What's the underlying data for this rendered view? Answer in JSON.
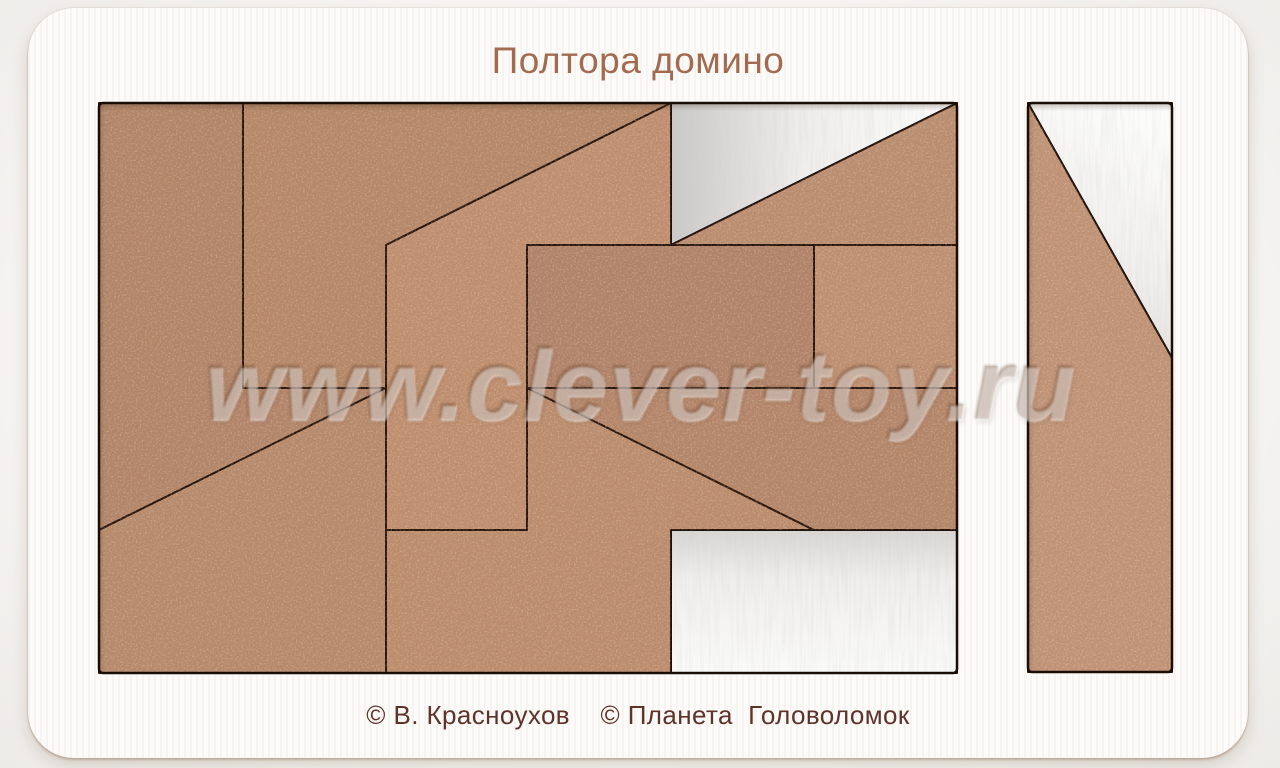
{
  "page": {
    "background": "#f2f1ef"
  },
  "card": {
    "title": "Полтора домино",
    "title_color": "#a26b50",
    "caption": "© В. Красноухов    © Планета  Головоломок",
    "caption_color": "#5e332a"
  },
  "watermark": {
    "text": "www.clever-toy.ru"
  },
  "puzzle": {
    "cut_color": "#23120a",
    "tray_outline_color": "#1a0d06",
    "backing_color": "#f2f1ee",
    "trays": [
      {
        "name": "main-tray-opening",
        "x": 99,
        "y": 103,
        "w": 858,
        "h": 570
      },
      {
        "name": "side-tray-opening",
        "x": 1028,
        "y": 103,
        "w": 144,
        "h": 569
      }
    ],
    "pieces": [
      {
        "id": "piece-left-pentagon",
        "color": "#b4866a",
        "points": [
          [
            99,
            103
          ],
          [
            243,
            103
          ],
          [
            243,
            388
          ],
          [
            386,
            388
          ],
          [
            99,
            530
          ]
        ]
      },
      {
        "id": "piece-bottom-left-quad",
        "color": "#b98b6d",
        "points": [
          [
            99,
            530
          ],
          [
            386,
            388
          ],
          [
            386,
            673
          ],
          [
            99,
            673
          ]
        ]
      },
      {
        "id": "piece-top-pentagon",
        "color": "#b78969",
        "points": [
          [
            243,
            103
          ],
          [
            671,
            103
          ],
          [
            386,
            245
          ],
          [
            386,
            388
          ],
          [
            243,
            388
          ]
        ]
      },
      {
        "id": "piece-middle-flag",
        "color": "#c19070",
        "points": [
          [
            386,
            245
          ],
          [
            671,
            103
          ],
          [
            671,
            245
          ],
          [
            527,
            245
          ],
          [
            527,
            530
          ],
          [
            386,
            530
          ]
        ]
      },
      {
        "id": "piece-bottom-step",
        "color": "#bd8e6e",
        "points": [
          [
            527,
            388
          ],
          [
            814,
            530
          ],
          [
            671,
            530
          ],
          [
            671,
            673
          ],
          [
            386,
            673
          ],
          [
            386,
            530
          ],
          [
            527,
            530
          ]
        ]
      },
      {
        "id": "piece-right-trapezoid",
        "color": "#b5876b",
        "points": [
          [
            527,
            388
          ],
          [
            957,
            388
          ],
          [
            957,
            530
          ],
          [
            814,
            530
          ]
        ]
      },
      {
        "id": "piece-top-right-triangle",
        "color": "#bd8f72",
        "points": [
          [
            671,
            245
          ],
          [
            957,
            103
          ],
          [
            957,
            245
          ]
        ]
      },
      {
        "id": "piece-right-square",
        "color": "#c09173",
        "points": [
          [
            814,
            245
          ],
          [
            957,
            245
          ],
          [
            957,
            388
          ],
          [
            814,
            388
          ]
        ]
      },
      {
        "id": "piece-domino-rect",
        "color": "#b2846a",
        "points": [
          [
            527,
            245
          ],
          [
            814,
            245
          ],
          [
            814,
            388
          ],
          [
            527,
            388
          ]
        ]
      },
      {
        "id": "piece-side-tray-clipped",
        "color": "#c29478",
        "points": [
          [
            1028,
            103
          ],
          [
            1172,
            358
          ],
          [
            1172,
            672
          ],
          [
            1028,
            672
          ]
        ]
      }
    ],
    "empty_slots": [
      {
        "id": "empty-slot-top-triangle",
        "shade": "right",
        "points": [
          [
            671,
            103
          ],
          [
            957,
            103
          ],
          [
            671,
            245
          ]
        ]
      },
      {
        "id": "empty-slot-bottom-rect",
        "shade": "down",
        "points": [
          [
            671,
            530
          ],
          [
            957,
            530
          ],
          [
            957,
            673
          ],
          [
            671,
            673
          ]
        ]
      },
      {
        "id": "empty-slot-side-triangle",
        "shade": "diag",
        "points": [
          [
            1028,
            103
          ],
          [
            1172,
            103
          ],
          [
            1172,
            358
          ]
        ]
      }
    ]
  }
}
